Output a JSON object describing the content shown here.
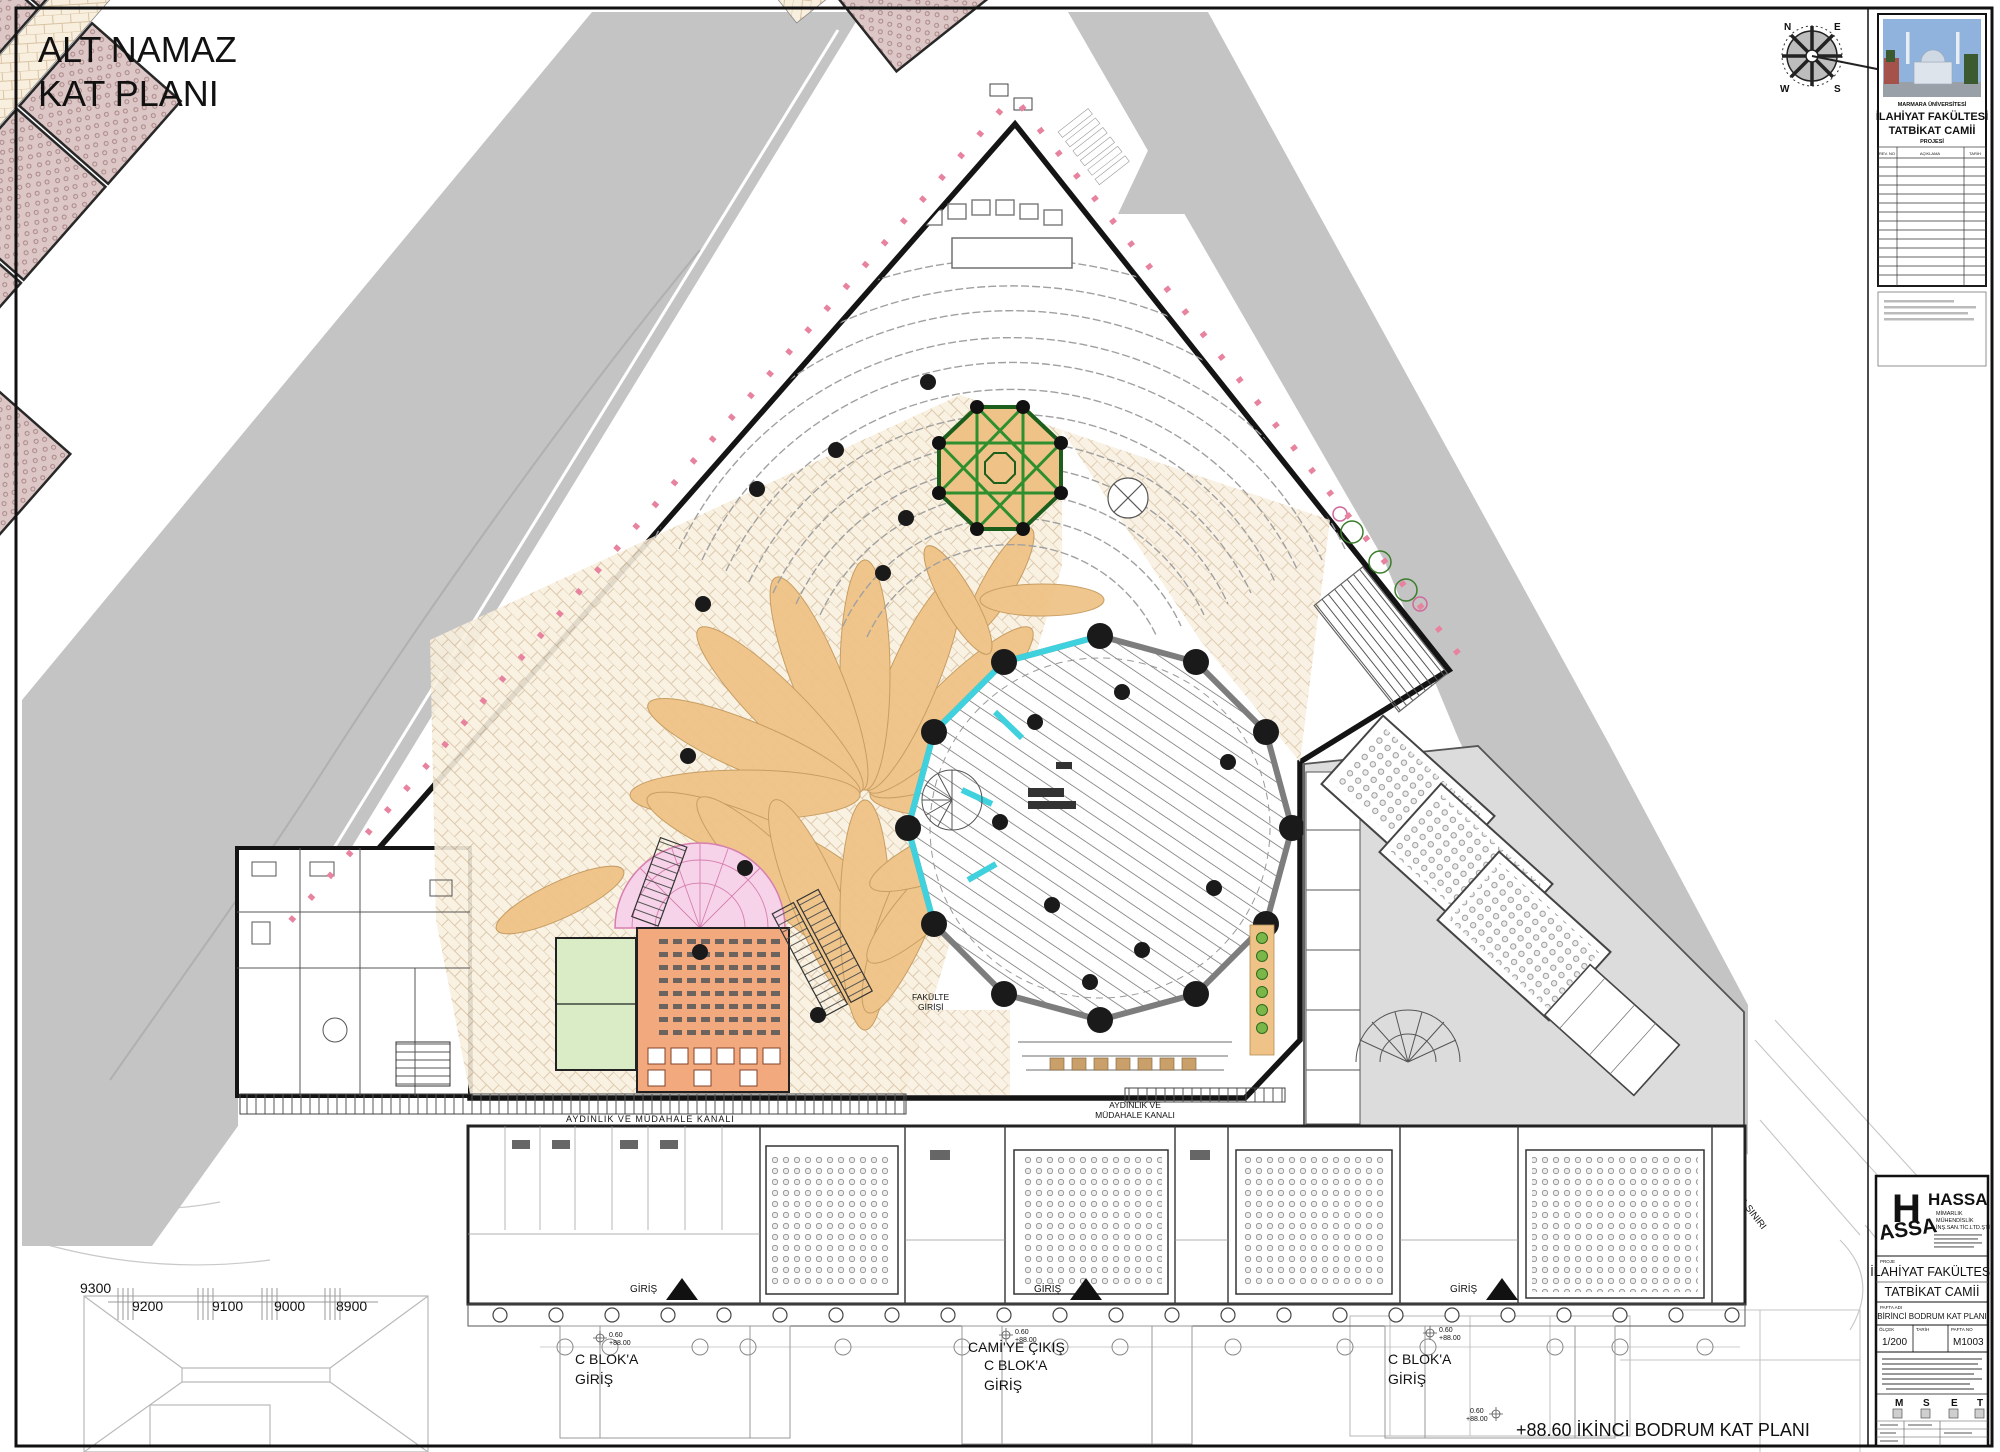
{
  "sheet": {
    "title_line1": "ALT NAMAZ",
    "title_line2": "KAT PLANI",
    "caption": "+88.60  İKİNCİ BODRUM KAT PLANI"
  },
  "titleblock_top": {
    "university": "MARMARA ÜNİVERSİTESİ",
    "project_line1": "İLAHİYAT FAKÜLTESİ",
    "project_line2": "TATBİKAT CAMİİ",
    "project_line3": "PROJESİ",
    "rev_headers": [
      "REV. NO",
      "AÇIKLAMA",
      "TARİH"
    ]
  },
  "titleblock_bottom": {
    "logo_top": "H",
    "logo_bottom": "ASSA",
    "firm": "HASSA",
    "firm_sub1": "MİMARLIK",
    "firm_sub2": "MÜHENDİSLİK",
    "firm_sub3": "İNŞ.SAN.TİC.LTD.ŞTİ.",
    "project_label": "PROJE",
    "project_name1": "İLAHİYAT FAKÜLTESİ",
    "project_name2": "TATBİKAT CAMİİ",
    "sheet_label": "PAFTA ADI",
    "sheet_name": "BİRİNCİ BODRUM KAT PLANI",
    "scale_label": "ÖLÇEK",
    "scale_value": "1/200",
    "date_label": "TARİH",
    "sheet_no_label": "PAFTA NO",
    "sheet_no_value": "M1003",
    "disc_m": "M",
    "disc_s": "S",
    "disc_e": "E",
    "disc_t": "T"
  },
  "plan": {
    "channel1": "AYDINLIK VE MÜDAHALE KANALI",
    "channel2_l1": "AYDINLIK VE",
    "channel2_l2": "MÜDAHALE KANALI",
    "entry_left_l1": "C BLOK'A",
    "entry_left_l2": "GİRİŞ",
    "entry_center_l1": "CAMİ'YE ÇIKIŞ",
    "entry_center_l2": "C BLOK'A",
    "entry_center_l3": "GİRİŞ",
    "entry_right_l1": "C BLOK'A",
    "entry_right_l2": "GİRİŞ",
    "giris": "GİRİŞ",
    "fakulte_l1": "FAKÜLTE",
    "fakulte_l2": "GİRİŞİ",
    "setback": "YAPI YAKLAŞMA SINIRI",
    "elev_val": "0.60",
    "elev_datum": "+88.00"
  },
  "site": {
    "n9300": "9300",
    "n9200": "9200",
    "n9100": "9100",
    "n9000": "9000",
    "n8900": "8900"
  },
  "compass": {
    "n": "N",
    "e": "E",
    "s": "S",
    "w": "W"
  },
  "colors": {
    "road": "#c4c4c4",
    "wing_gray": "#dcdcdc",
    "room_pink": "#dcc6c6",
    "paving_bg": "#f8efde",
    "petal": "#efc387",
    "star_green": "#2f8f2f",
    "star_green_dark": "#1c5e1c",
    "cyan": "#3fd2de",
    "salmon": "#f2a97e",
    "soft_green": "#daecc5",
    "fan_pink": "#f6d3e8",
    "marker_pink": "#e8839f",
    "plant_green": "#7ab648"
  }
}
